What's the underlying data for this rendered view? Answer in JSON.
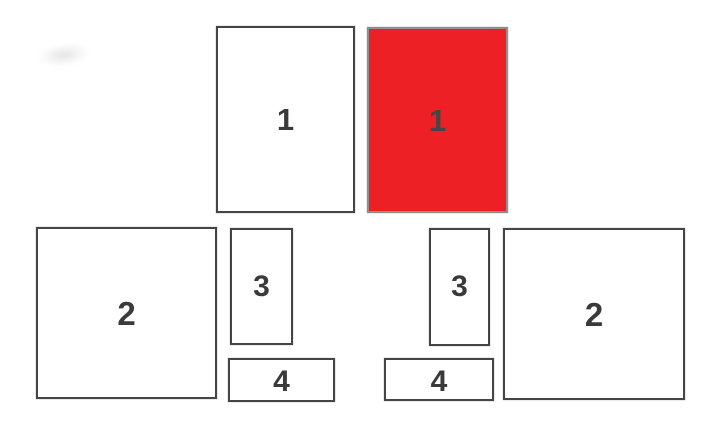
{
  "diagram": {
    "shapes": [
      {
        "id": "panel-1-plain",
        "label": "1",
        "fill": "#ffffff"
      },
      {
        "id": "panel-1-highlighted",
        "label": "1",
        "fill": "#ec2025"
      },
      {
        "id": "panel-2-left",
        "label": "2",
        "fill": "#ffffff"
      },
      {
        "id": "panel-3-left",
        "label": "3",
        "fill": "#ffffff"
      },
      {
        "id": "panel-4-left",
        "label": "4",
        "fill": "#ffffff"
      },
      {
        "id": "panel-3-right",
        "label": "3",
        "fill": "#ffffff"
      },
      {
        "id": "panel-4-right",
        "label": "4",
        "fill": "#ffffff"
      },
      {
        "id": "panel-2-right",
        "label": "2",
        "fill": "#ffffff"
      }
    ],
    "colors": {
      "highlight_fill": "#ec2025",
      "outline": "#454545",
      "outline_highlighted": "#8f8f8f",
      "label_text": "#3a3a3a",
      "background": "#ffffff"
    }
  }
}
